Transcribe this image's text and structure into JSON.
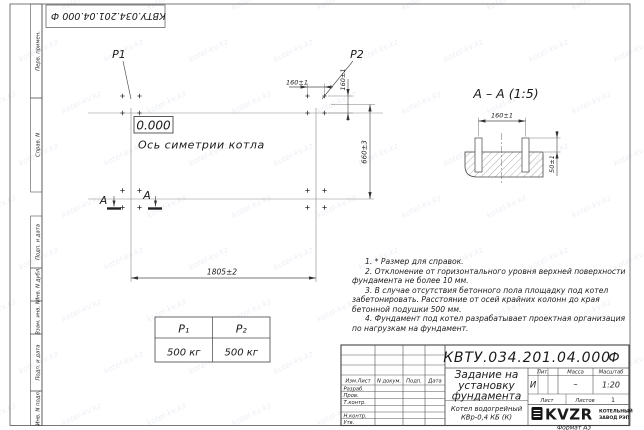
{
  "sheet": {
    "doc_number": "КВТУ.034.201.04.000",
    "doc_suffix": "Ф",
    "format_label": "Формат А3"
  },
  "margin_labels": [
    "Перв. примен.",
    "Справ. N",
    "Подп. и дата",
    "Инв. N дубл.",
    "Взам. инв. N",
    "Подп. и дата",
    "Инв. N подл."
  ],
  "plan": {
    "p1": "P1",
    "p2": "P2",
    "elevation": "0.000",
    "axis_label": "Ось симетрии котла",
    "dim_bolt_h": "160±1",
    "dim_bolt_v": "160±1",
    "dim_height": "660±3",
    "dim_width": "1805±2",
    "section_letter": "А"
  },
  "section_view": {
    "title": "А – А (1:5)",
    "dim_spacing": "160±1",
    "dim_protrusion": "50±1"
  },
  "notes": [
    "1. * Размер для справок.",
    "2. Отклонение от горизонтального уровня верхней поверхности фундамента не более 10 мм.",
    "3. В случае отсутствия бетонного пола площадку под котел забетонировать. Расстояние от осей крайних колонн до края бетонной подушки 500 мм.",
    "4. Фундамент под котел разрабатывает проектная организация по нагрузкам на фундамент."
  ],
  "load_table": {
    "p1_header": "Р₁",
    "p2_header": "Р₂",
    "p1_value": "500 кг",
    "p2_value": "500 кг"
  },
  "title_block": {
    "header_cols": [
      "Изм.Лист",
      "N докум.",
      "Подп.",
      "Дата"
    ],
    "sig_rows": [
      "Разраб.",
      "Пров.",
      "Т.контр.",
      "Н.контр.",
      "Утв."
    ],
    "title_lines": [
      "Задание на",
      "установку",
      "фундамента"
    ],
    "product_lines": [
      "Котел водогрейный",
      "КВр-0,4 КБ (К)"
    ],
    "lit_header": "Лит.",
    "mass_header": "Масса",
    "scale_header": "Масштаб",
    "lit_value": "И",
    "mass_value": "–",
    "scale_value": "1:20",
    "sheet_label": "Лист",
    "sheets_label": "Листов",
    "sheets_value": "1",
    "logo_text": "KVZR",
    "logo_caption": [
      "КОТЕЛЬНЫЙ",
      "ЗАВОД РЭП"
    ]
  },
  "watermark": "kotel-kv.kz"
}
